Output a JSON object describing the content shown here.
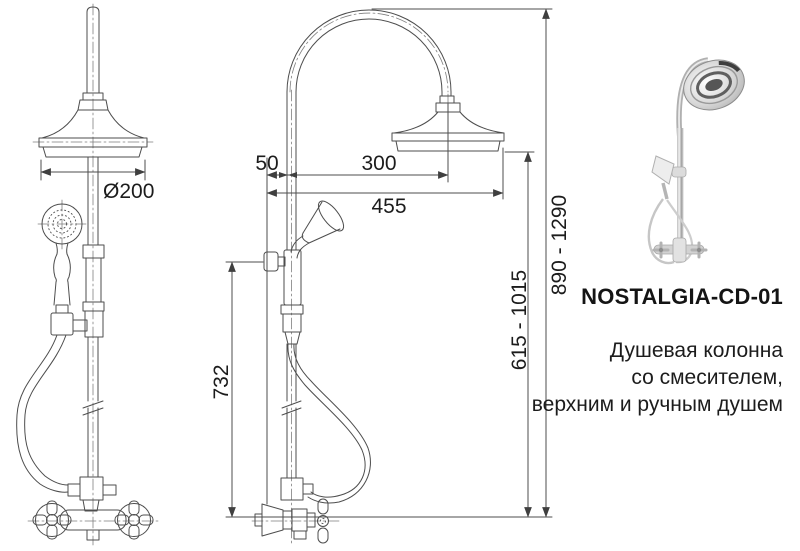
{
  "page": {
    "background": "#ffffff"
  },
  "drawing": {
    "line_color": "#4d4d4d",
    "front_view": {
      "dim_labels": {
        "head_diameter": "Ø200"
      }
    },
    "side_view": {
      "dim_labels": {
        "wall_to_column": "50",
        "column_to_head_center": "300",
        "overall_reach": "455",
        "holder_to_mixer": "732",
        "handshower_height": "615 - 1015",
        "overall_height": "890 - 1290"
      }
    }
  },
  "product": {
    "model": "NOSTALGIA-CD-01",
    "description_lines": [
      "Душевая колонна",
      "со смесителем,",
      "верхним и ручным душем"
    ]
  }
}
